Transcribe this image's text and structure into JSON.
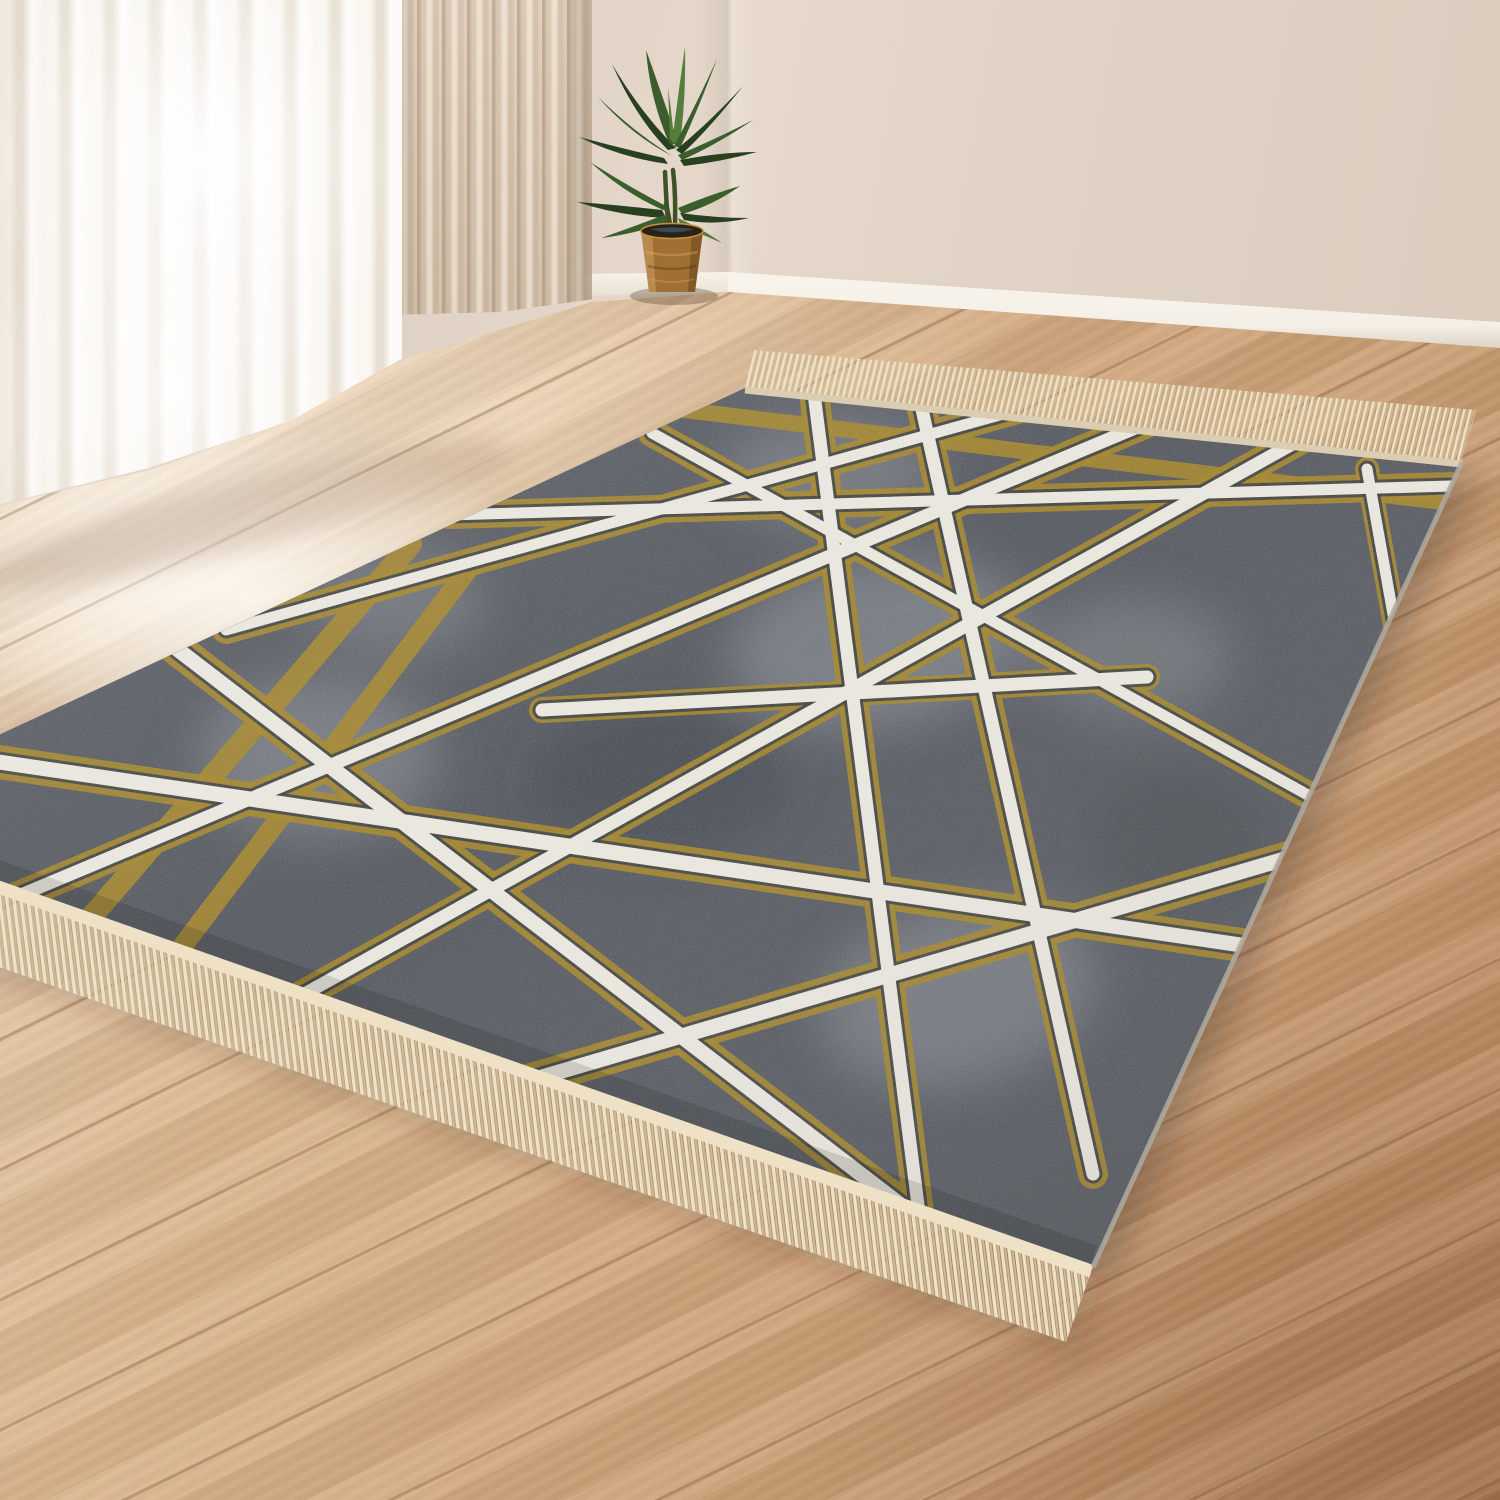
{
  "meta": {
    "title": "Modern fringed area rug in bright room — product photo",
    "description": "A rectangular area rug lies diagonally on a light oak plank floor in a bright room corner. The rug has a mottled charcoal-gray ground crossed by an abstract web of straight cream-white lines haloed with distressed mustard-gold. Both short ends have cream fringe tassels. Behind it: sheer white curtains over a glowing window, a beige drape, beige walls with white baseboard, and a green potted plant in a woven brown planter."
  },
  "scene": {
    "setting": "bright room corner, daylight from window at left",
    "subject": "gray and gold abstract-line fringed rug",
    "objects": [
      {
        "name": "sheer-curtain",
        "desc": "backlit sheer white curtain panels reaching the floor"
      },
      {
        "name": "beige-curtain",
        "desc": "opaque beige drape with fine vertical folds"
      },
      {
        "name": "wall",
        "desc": "beige painted walls meeting in a corner"
      },
      {
        "name": "baseboard",
        "desc": "white skirting board along wall base"
      },
      {
        "name": "potted-plant",
        "desc": "green palm-like plant in tapered woven brown pot"
      },
      {
        "name": "wood-floor",
        "desc": "light oak planks with diagonal seams, warm toward bottom right"
      },
      {
        "name": "area-rug",
        "desc": "charcoal rug with crossing cream lines edged in gold, cream fringe on short ends"
      }
    ],
    "rug": {
      "ground": "mottled charcoal gray with lighter gray patches",
      "pattern": "randomly crossing straight lines, cream-white core with rough gold halo",
      "fringe": "cream tassel fringe on near and far short edges",
      "orientation": "rotated diagonally, near corner pointing toward lower right"
    }
  },
  "colors": {
    "wall": "#e0d2c5",
    "wall_dark": "#d3c2b2",
    "baseboard": "#f4efe7",
    "floor_light": "#ecd8bf",
    "floor_mid": "#d2a87e",
    "floor_dark": "#b5845a",
    "seam": "rgba(125,85,52,0.35)",
    "curtain_sheer": "#f8f4ee",
    "curtain_beige": "#d9c6b1",
    "plant_dark": "#283f20",
    "plant_mid": "#3c5e2d",
    "plant_light": "#567d3b",
    "pot": "#a06f33",
    "pot_dark": "#6b4a21",
    "rug_base": "#4a4f57",
    "rug_patch": "#8b9199",
    "rug_patch_dark": "#343a41",
    "rug_line": "#eae7df",
    "rug_line_edge": "#2e3339",
    "rug_gold": "#9c7d1e",
    "fringe": "#eee2c7",
    "fringe_shade": "#cdbb97",
    "shadow": "rgba(50,36,22,0.28)"
  }
}
